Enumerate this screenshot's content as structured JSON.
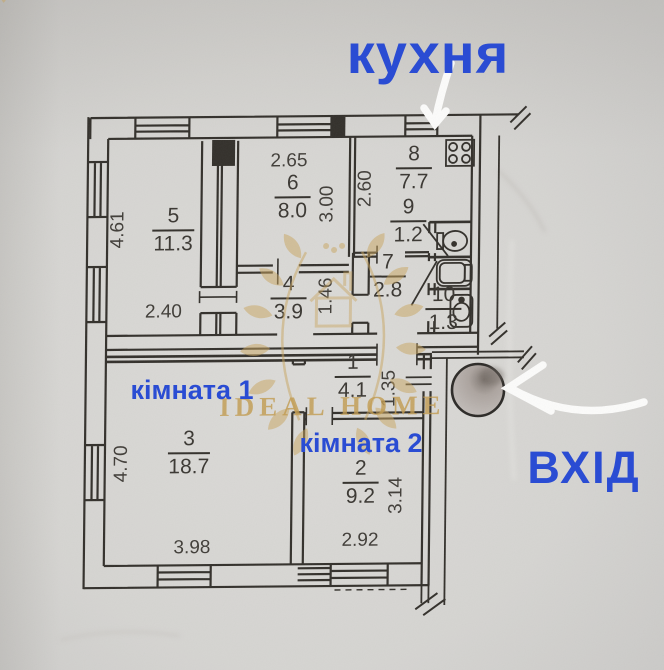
{
  "annotations": {
    "kitchen_label": "кухня",
    "room1_label": "кімната 1",
    "room2_label": "кімната 2",
    "entrance_label": "ВХІД"
  },
  "watermark": {
    "brand": "IDEAL HOME"
  },
  "colors": {
    "annotation_blue": "#2a4cd3",
    "watermark_gold": "#c9a55e",
    "ink": "#33302b",
    "paper": "#d6d5d2",
    "arrow_white": "#fbfbfa"
  },
  "plan": {
    "rooms": [
      {
        "number": "5",
        "area": "11.3",
        "x": 172,
        "y": 221
      },
      {
        "number": "6",
        "area": "8.0",
        "x": 291,
        "y": 189
      },
      {
        "number": "8",
        "area": "7.7",
        "x": 412,
        "y": 161
      },
      {
        "number": "9",
        "area": "1.2",
        "x": 407,
        "y": 214
      },
      {
        "number": "4",
        "area": "3.9",
        "x": 288,
        "y": 290
      },
      {
        "number": "7",
        "area": "2.8",
        "x": 387,
        "y": 269
      },
      {
        "number": "10",
        "area": "1.3",
        "x": 443,
        "y": 302
      },
      {
        "number": "1",
        "area": "4.1",
        "x": 353,
        "y": 369
      },
      {
        "number": "3",
        "area": "18.7",
        "x": 190,
        "y": 444
      },
      {
        "number": "2",
        "area": "9.2",
        "x": 362,
        "y": 475
      }
    ],
    "dimensions": [
      {
        "value": "2.65",
        "x": 287,
        "y": 166,
        "rot": 0
      },
      {
        "value": "3.00",
        "x": 331,
        "y": 204,
        "rot": -90
      },
      {
        "value": "2.60",
        "x": 369,
        "y": 189,
        "rot": -90
      },
      {
        "value": "4.61",
        "x": 122,
        "y": 228,
        "rot": -90
      },
      {
        "value": "2.40",
        "x": 163,
        "y": 316,
        "rot": 0
      },
      {
        "value": "1.46",
        "x": 331,
        "y": 296,
        "rot": -90
      },
      {
        "value": "1.35",
        "x": 395,
        "y": 389,
        "rot": -90
      },
      {
        "value": "4.70",
        "x": 128,
        "y": 462,
        "rot": -90
      },
      {
        "value": "3.98",
        "x": 194,
        "y": 552,
        "rot": 0
      },
      {
        "value": "2.92",
        "x": 362,
        "y": 546,
        "rot": 0
      },
      {
        "value": "3.14",
        "x": 403,
        "y": 496,
        "rot": -90
      }
    ]
  }
}
